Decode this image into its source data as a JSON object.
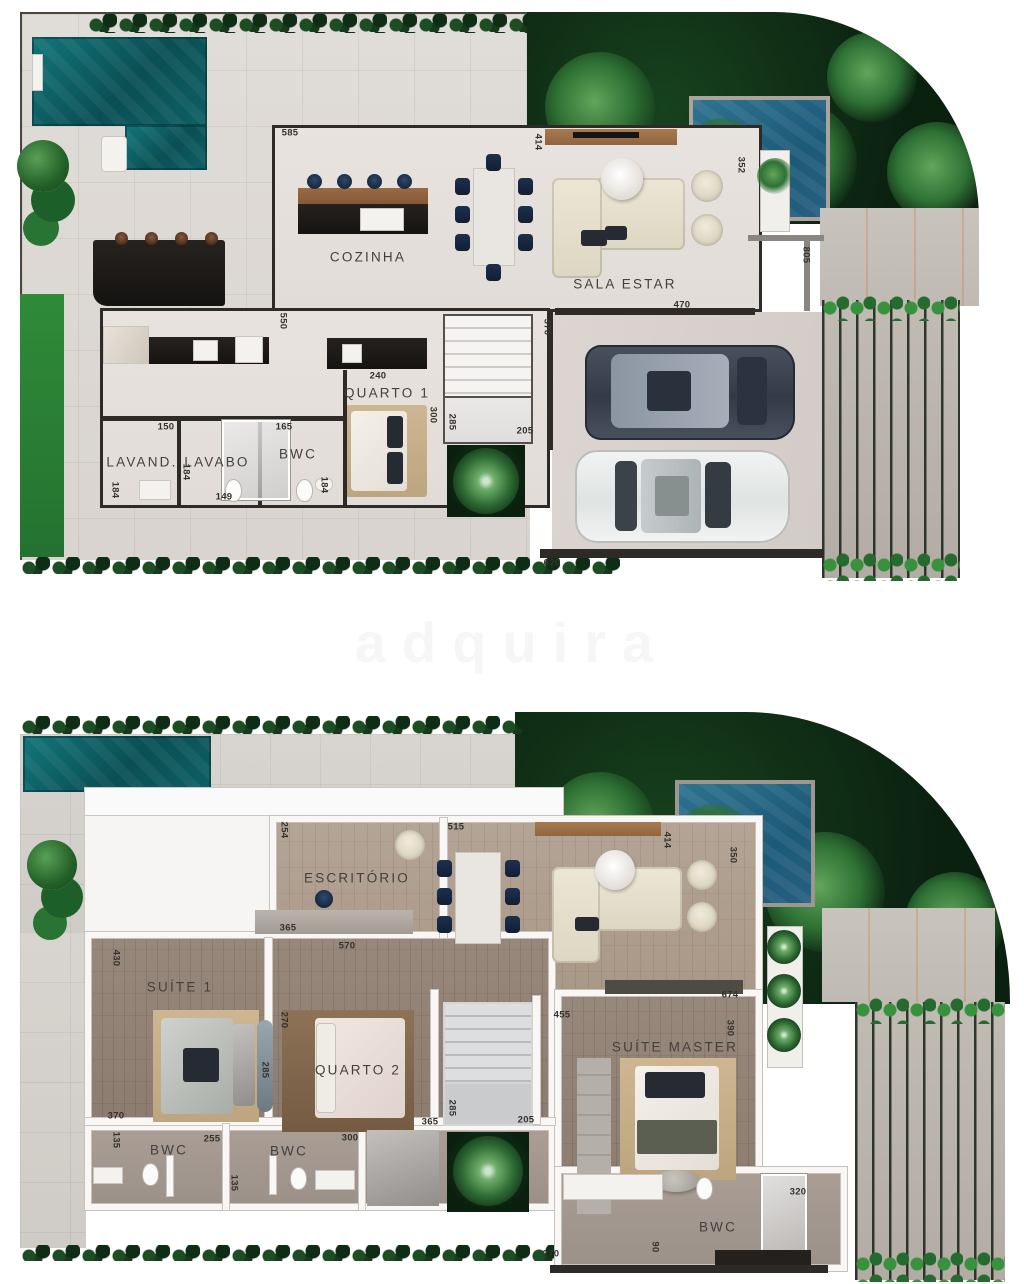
{
  "watermark": "adquira",
  "palette": {
    "wall_ground": "#2e2a27",
    "wall_upper": "#f8f7f5",
    "pool": "#0d6065",
    "plunge_pool": "#1c5a78",
    "garden": "#0b2110",
    "grass": "#2f8b38",
    "wood_floor": "#97887b",
    "deck": "#b2aca4",
    "accent_navy": "#1c2f4d",
    "cream": "#e9e3d3"
  },
  "plans": [
    {
      "id": "ground-floor",
      "labels": [
        {
          "t": "COZINHA",
          "k": "room",
          "x": 353,
          "y": 249
        },
        {
          "t": "SALA ESTAR",
          "k": "room",
          "x": 610,
          "y": 276
        },
        {
          "t": "QUARTO 1",
          "k": "room",
          "x": 372,
          "y": 385
        },
        {
          "t": "LAVAND.",
          "k": "room",
          "x": 127,
          "y": 454
        },
        {
          "t": "LAVABO",
          "k": "room",
          "x": 202,
          "y": 454
        },
        {
          "t": "BWC",
          "k": "room",
          "x": 283,
          "y": 446
        },
        {
          "t": "585",
          "k": "dim",
          "x": 275,
          "y": 125
        },
        {
          "t": "414",
          "k": "dim",
          "x": 523,
          "y": 134,
          "r": 1
        },
        {
          "t": "352",
          "k": "dim",
          "x": 726,
          "y": 157,
          "r": 1
        },
        {
          "t": "470",
          "k": "dim",
          "x": 667,
          "y": 297
        },
        {
          "t": "805",
          "k": "dim",
          "x": 791,
          "y": 247,
          "r": 1
        },
        {
          "t": "550",
          "k": "dim",
          "x": 268,
          "y": 313,
          "r": 1
        },
        {
          "t": "240",
          "k": "dim",
          "x": 363,
          "y": 368
        },
        {
          "t": "150",
          "k": "dim",
          "x": 151,
          "y": 419
        },
        {
          "t": "165",
          "k": "dim",
          "x": 269,
          "y": 419
        },
        {
          "t": "184",
          "k": "dim",
          "x": 100,
          "y": 482,
          "r": 1
        },
        {
          "t": "184",
          "k": "dim",
          "x": 171,
          "y": 464,
          "r": 1
        },
        {
          "t": "149",
          "k": "dim",
          "x": 209,
          "y": 489
        },
        {
          "t": "184",
          "k": "dim",
          "x": 309,
          "y": 477,
          "r": 1
        },
        {
          "t": "300",
          "k": "dim",
          "x": 418,
          "y": 407,
          "r": 1
        },
        {
          "t": "285",
          "k": "dim",
          "x": 437,
          "y": 414,
          "r": 1
        },
        {
          "t": "205",
          "k": "dim",
          "x": 510,
          "y": 423
        },
        {
          "t": "570",
          "k": "dim",
          "x": 532,
          "y": 319,
          "r": 1
        },
        {
          "t": "620",
          "k": "dim",
          "x": 537,
          "y": 555
        }
      ]
    },
    {
      "id": "upper-floor",
      "labels": [
        {
          "t": "ESCRITÓRIO",
          "k": "room",
          "x": 342,
          "y": 166
        },
        {
          "t": "SUÍTE 1",
          "k": "room",
          "x": 165,
          "y": 275
        },
        {
          "t": "QUARTO 2",
          "k": "room",
          "x": 343,
          "y": 358
        },
        {
          "t": "SUÍTE MASTER",
          "k": "room",
          "x": 660,
          "y": 335
        },
        {
          "t": "BWC",
          "k": "room",
          "x": 154,
          "y": 438
        },
        {
          "t": "BWC",
          "k": "room",
          "x": 274,
          "y": 439
        },
        {
          "t": "BWC",
          "k": "room",
          "x": 703,
          "y": 515
        },
        {
          "t": "254",
          "k": "dim",
          "x": 269,
          "y": 118,
          "r": 1
        },
        {
          "t": "515",
          "k": "dim",
          "x": 441,
          "y": 115
        },
        {
          "t": "414",
          "k": "dim",
          "x": 652,
          "y": 128,
          "r": 1
        },
        {
          "t": "350",
          "k": "dim",
          "x": 718,
          "y": 143,
          "r": 1
        },
        {
          "t": "365",
          "k": "dim",
          "x": 273,
          "y": 216
        },
        {
          "t": "570",
          "k": "dim",
          "x": 332,
          "y": 234
        },
        {
          "t": "430",
          "k": "dim",
          "x": 101,
          "y": 246,
          "r": 1
        },
        {
          "t": "674",
          "k": "dim",
          "x": 715,
          "y": 283
        },
        {
          "t": "455",
          "k": "dim",
          "x": 547,
          "y": 303
        },
        {
          "t": "390",
          "k": "dim",
          "x": 715,
          "y": 316,
          "r": 1
        },
        {
          "t": "370",
          "k": "dim",
          "x": 101,
          "y": 404
        },
        {
          "t": "285",
          "k": "dim",
          "x": 250,
          "y": 358,
          "r": 1
        },
        {
          "t": "270",
          "k": "dim",
          "x": 269,
          "y": 308,
          "r": 1
        },
        {
          "t": "365",
          "k": "dim",
          "x": 415,
          "y": 410
        },
        {
          "t": "300",
          "k": "dim",
          "x": 335,
          "y": 426
        },
        {
          "t": "255",
          "k": "dim",
          "x": 197,
          "y": 427
        },
        {
          "t": "135",
          "k": "dim",
          "x": 101,
          "y": 428,
          "r": 1
        },
        {
          "t": "135",
          "k": "dim",
          "x": 219,
          "y": 471,
          "r": 1
        },
        {
          "t": "285",
          "k": "dim",
          "x": 437,
          "y": 396,
          "r": 1
        },
        {
          "t": "205",
          "k": "dim",
          "x": 511,
          "y": 408
        },
        {
          "t": "320",
          "k": "dim",
          "x": 783,
          "y": 480
        },
        {
          "t": "90",
          "k": "dim",
          "x": 640,
          "y": 535,
          "r": 1
        },
        {
          "t": "270",
          "k": "dim",
          "x": 536,
          "y": 542
        }
      ]
    }
  ]
}
